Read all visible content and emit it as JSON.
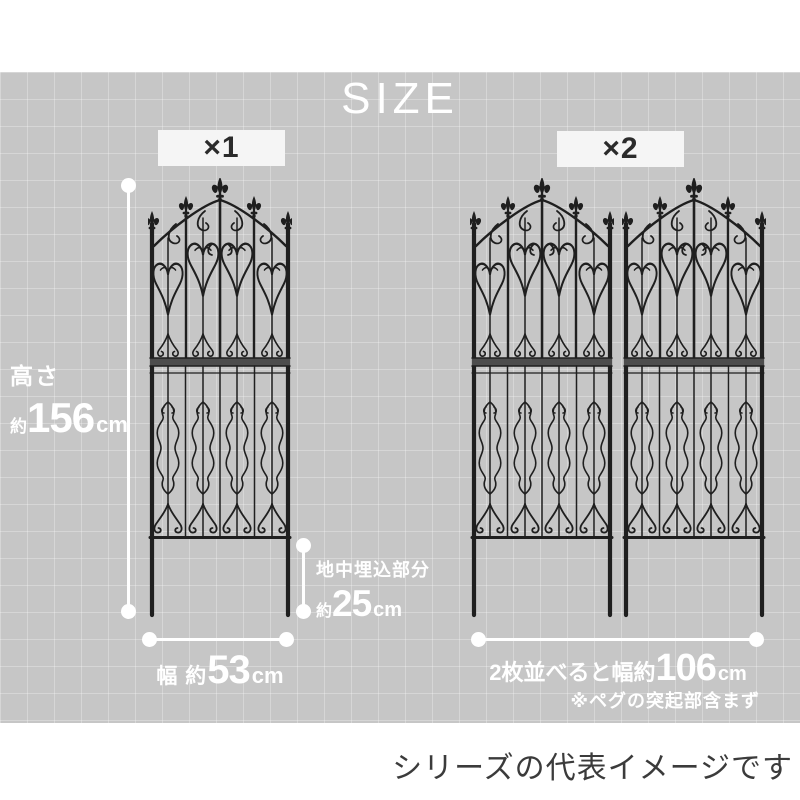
{
  "title": "SIZE",
  "badges": {
    "single": "×1",
    "double": "×2"
  },
  "dimensions": {
    "height": {
      "line1": "高さ",
      "prefix": "約",
      "value": "156",
      "unit": "cm"
    },
    "buried": {
      "line1": "地中埋込部分",
      "prefix": "約",
      "value": "25",
      "unit": "cm"
    },
    "width_single": {
      "prefix": "幅 約",
      "value": "53",
      "unit": "cm"
    },
    "width_double": {
      "prefix": "2枚並べると幅約",
      "value": "106",
      "unit": "cm"
    },
    "peg_note": "※ペグの突起部含まず"
  },
  "footer": "シリーズの代表イメージです",
  "illustration": {
    "name": "decorative-iron-garden-fence",
    "panels_left": 1,
    "panels_right": 2
  },
  "colors": {
    "stage_background": "#c6c6c6",
    "grid_line": "#d5d5d5",
    "dimension_white": "#ffffff",
    "fence_iron": "#1f1f1f",
    "badge_background": "#f5f5f5",
    "badge_text": "#2b2b2b",
    "footer_text": "#3b3b3b"
  }
}
